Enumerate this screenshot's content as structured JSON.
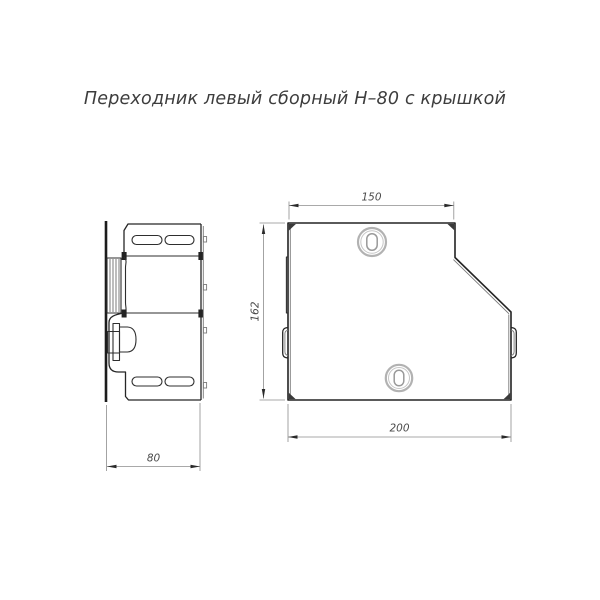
{
  "title": "Переходник левый сборный Н–80 с крышкой",
  "drawing": {
    "dimensions": {
      "side_width": "80",
      "front_top_width": "150",
      "front_height": "162",
      "front_bottom_width": "200"
    },
    "colors": {
      "background": "#ffffff",
      "outline": "#232323",
      "thin_line": "#7a7a7a",
      "dimension_line": "#8c8c8c",
      "dimension_text": "#4a4a4a",
      "fastener_gray": "#b2b2b2",
      "title_text": "#3d3d3d"
    }
  }
}
